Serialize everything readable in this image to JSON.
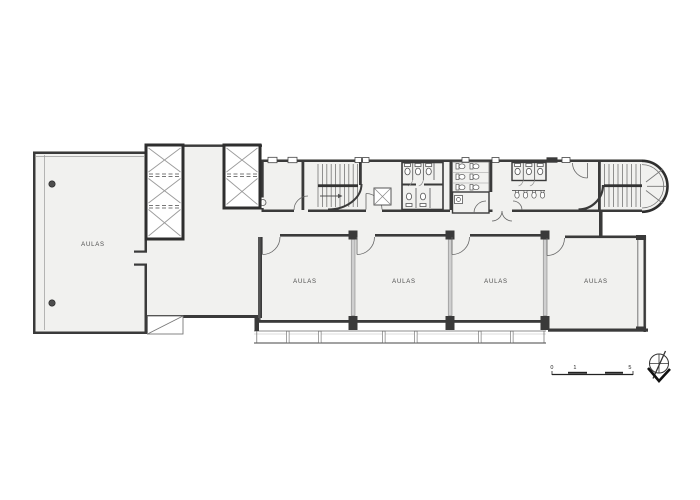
{
  "plan": {
    "rooms": [
      {
        "id": "room-left-large",
        "label": "AULAS"
      },
      {
        "id": "classroom-1",
        "label": "AULAS"
      },
      {
        "id": "classroom-2",
        "label": "AULAS"
      },
      {
        "id": "classroom-3",
        "label": "AULAS"
      },
      {
        "id": "classroom-4",
        "label": "AULAS"
      }
    ],
    "scale_bar": {
      "labels": [
        "0",
        "1",
        "5"
      ]
    },
    "icons": {
      "north_arrow": "north-arrow",
      "elevator_shaft": "x-braced-shaft",
      "stairs": "stair-run",
      "toilet": "toilet",
      "urinal": "urinal",
      "door": "door-swing",
      "ramp": "ramp-diagonal",
      "column": "column-dot"
    },
    "colors": {
      "wall": "#3a3a3a",
      "mid_line": "#6f6f6f",
      "light_line": "#9a9a9a",
      "floor": "#f1f1ef",
      "background": "#ffffff"
    }
  }
}
